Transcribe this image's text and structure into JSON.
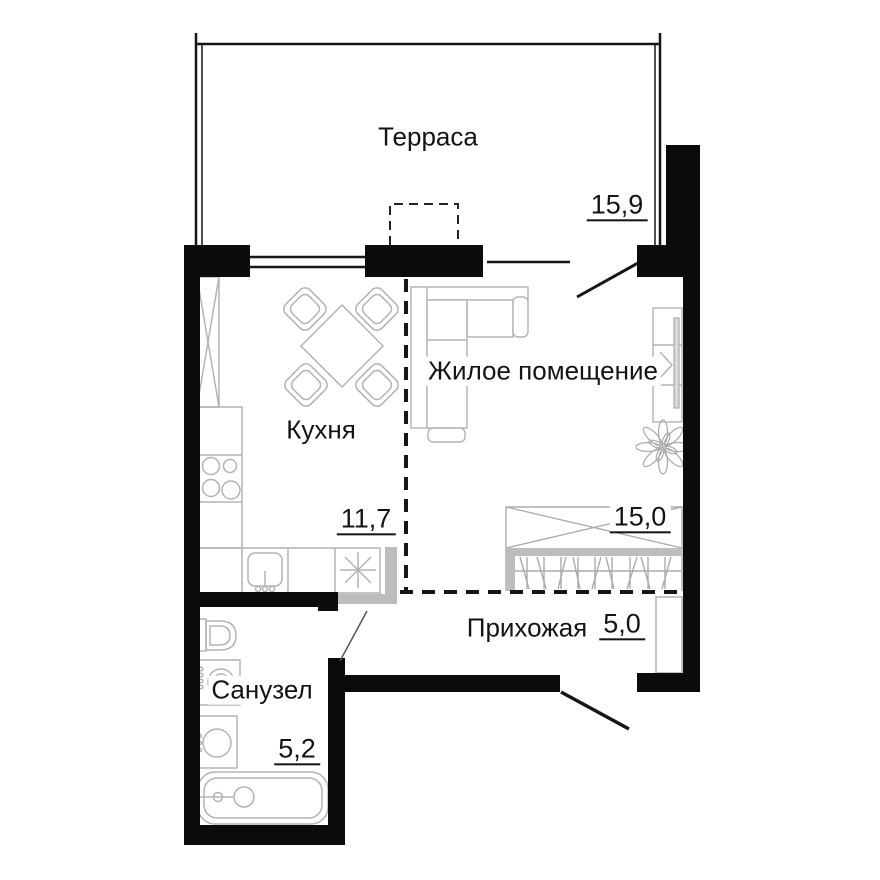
{
  "plan": {
    "rooms": [
      {
        "id": "terrace",
        "name": "Терраса",
        "area": "15,9"
      },
      {
        "id": "kitchen",
        "name": "Кухня",
        "area": "11,7"
      },
      {
        "id": "living",
        "name": "Жилое помещение",
        "area": "15,0"
      },
      {
        "id": "hallway",
        "name": "Прихожая",
        "area": "5,0"
      },
      {
        "id": "bathroom",
        "name": "Санузел",
        "area": "5,2"
      }
    ],
    "colors": {
      "wall": "#0b0b0b",
      "furniture": "#b3b3b3",
      "partition": "#bdbdbd",
      "line": "#161616",
      "background": "#ffffff"
    }
  }
}
